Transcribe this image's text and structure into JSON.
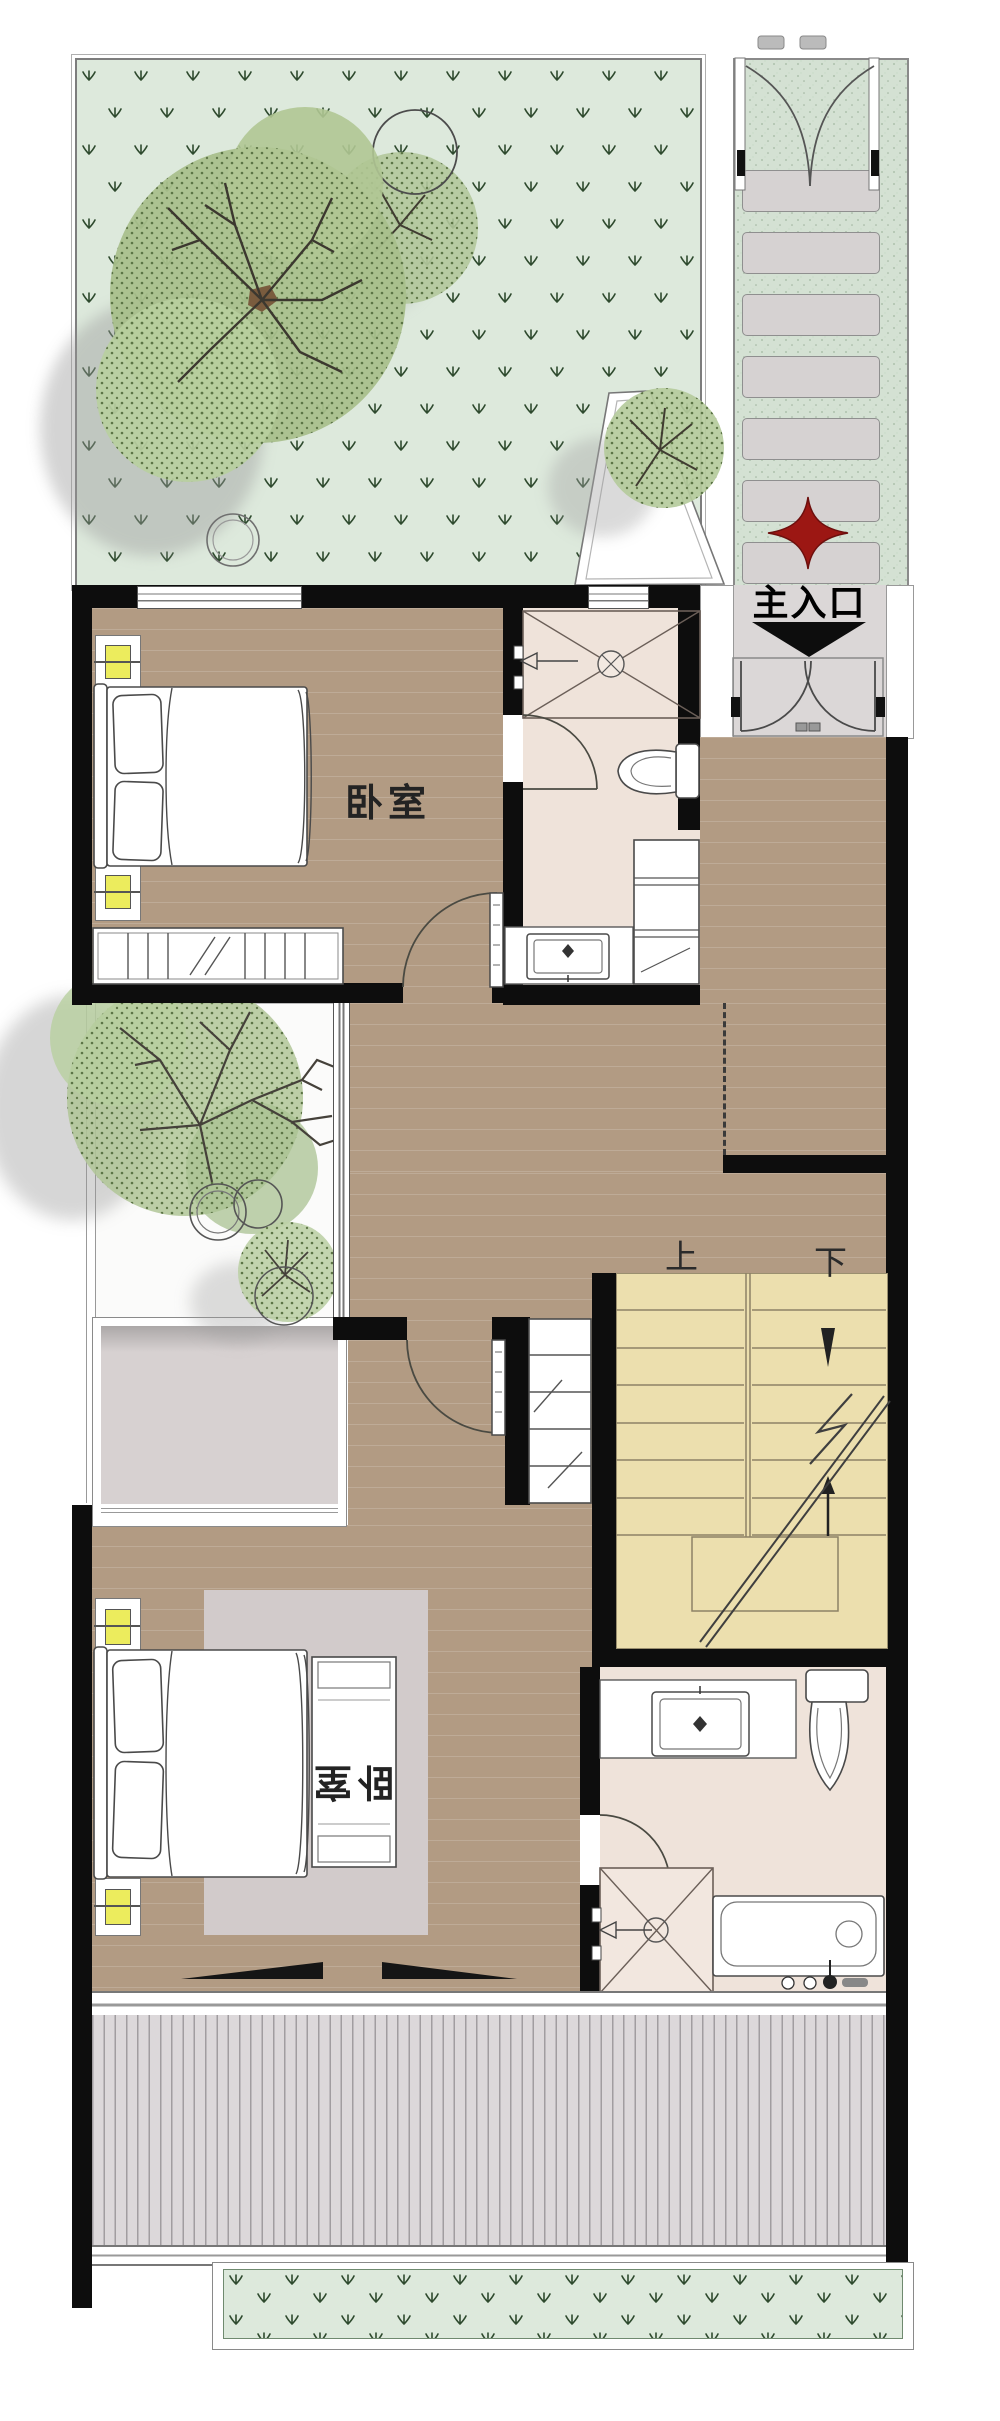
{
  "labels": {
    "main_entrance": "主入口",
    "bedroom_upper": "卧室",
    "bedroom_lower": "卧室",
    "stairs_up": "上",
    "stairs_down": "下"
  },
  "colors": {
    "wall": "#0d0d0d",
    "wood_floor": "#b29b83",
    "bath_floor": "#efe3da",
    "stair_tread": "#ecdfae",
    "garden_green": "#dde9dc",
    "walkway_green": "#d4e1d3",
    "terrace_gray": "#d7d1d1",
    "deck_gray": "#dcd8da",
    "porch_gray": "#dbd7d7",
    "stone_gray": "#d6d2d2",
    "entrance_red": "#9c1713",
    "nightstand_yellow": "#ecec5d",
    "foliage_green": "#a9c28d",
    "rug_gray": "#d2cbcb"
  }
}
